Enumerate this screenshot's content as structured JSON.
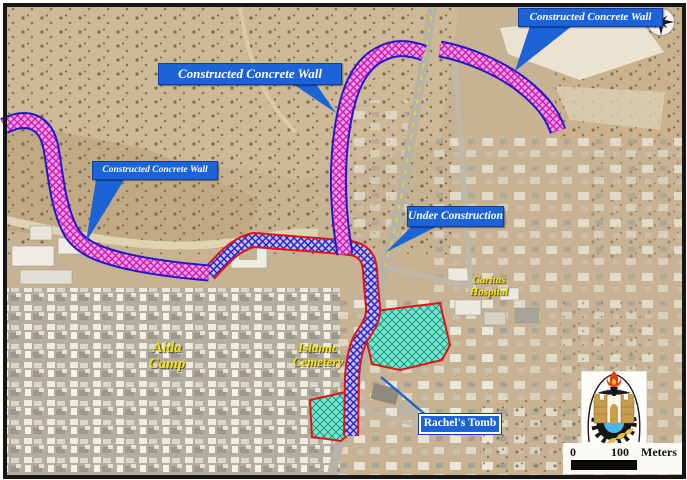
{
  "annotations": {
    "wall_label_top_right": "Constructed Concrete Wall",
    "wall_label_top_center": "Constructed Concrete Wall",
    "wall_label_left": "Constructed Concrete Wall",
    "under_construction": "Under Construction",
    "rachels_tomb": "Rachel's Tomb"
  },
  "place_labels": {
    "aida_camp": {
      "line1": "Aida",
      "line2": "Camp"
    },
    "islamic_cemetery": {
      "line1": "Islamic",
      "line2": "Cemetery"
    },
    "caritas_hospital": {
      "line1": "Caritas",
      "line2": "Hospital"
    }
  },
  "scale_bar": {
    "start": "0",
    "end": "100",
    "unit": "Meters"
  },
  "colors": {
    "annotation_box_blue": "#1b63d6",
    "constructed_wall_hatch_magenta": "#ce18b6",
    "constructed_wall_border_blue": "#2318c6",
    "under_construction_hatch_blue": "#2a1fc0",
    "under_construction_border_red": "#e01414",
    "cemetery_highlight_cyan": "#7ae4cc",
    "place_label_yellow": "#f2e416",
    "road_centerline_yellow": "#e6d23e"
  },
  "icons": {
    "compass": "compass-rose",
    "emblem": "municipality-emblem"
  }
}
